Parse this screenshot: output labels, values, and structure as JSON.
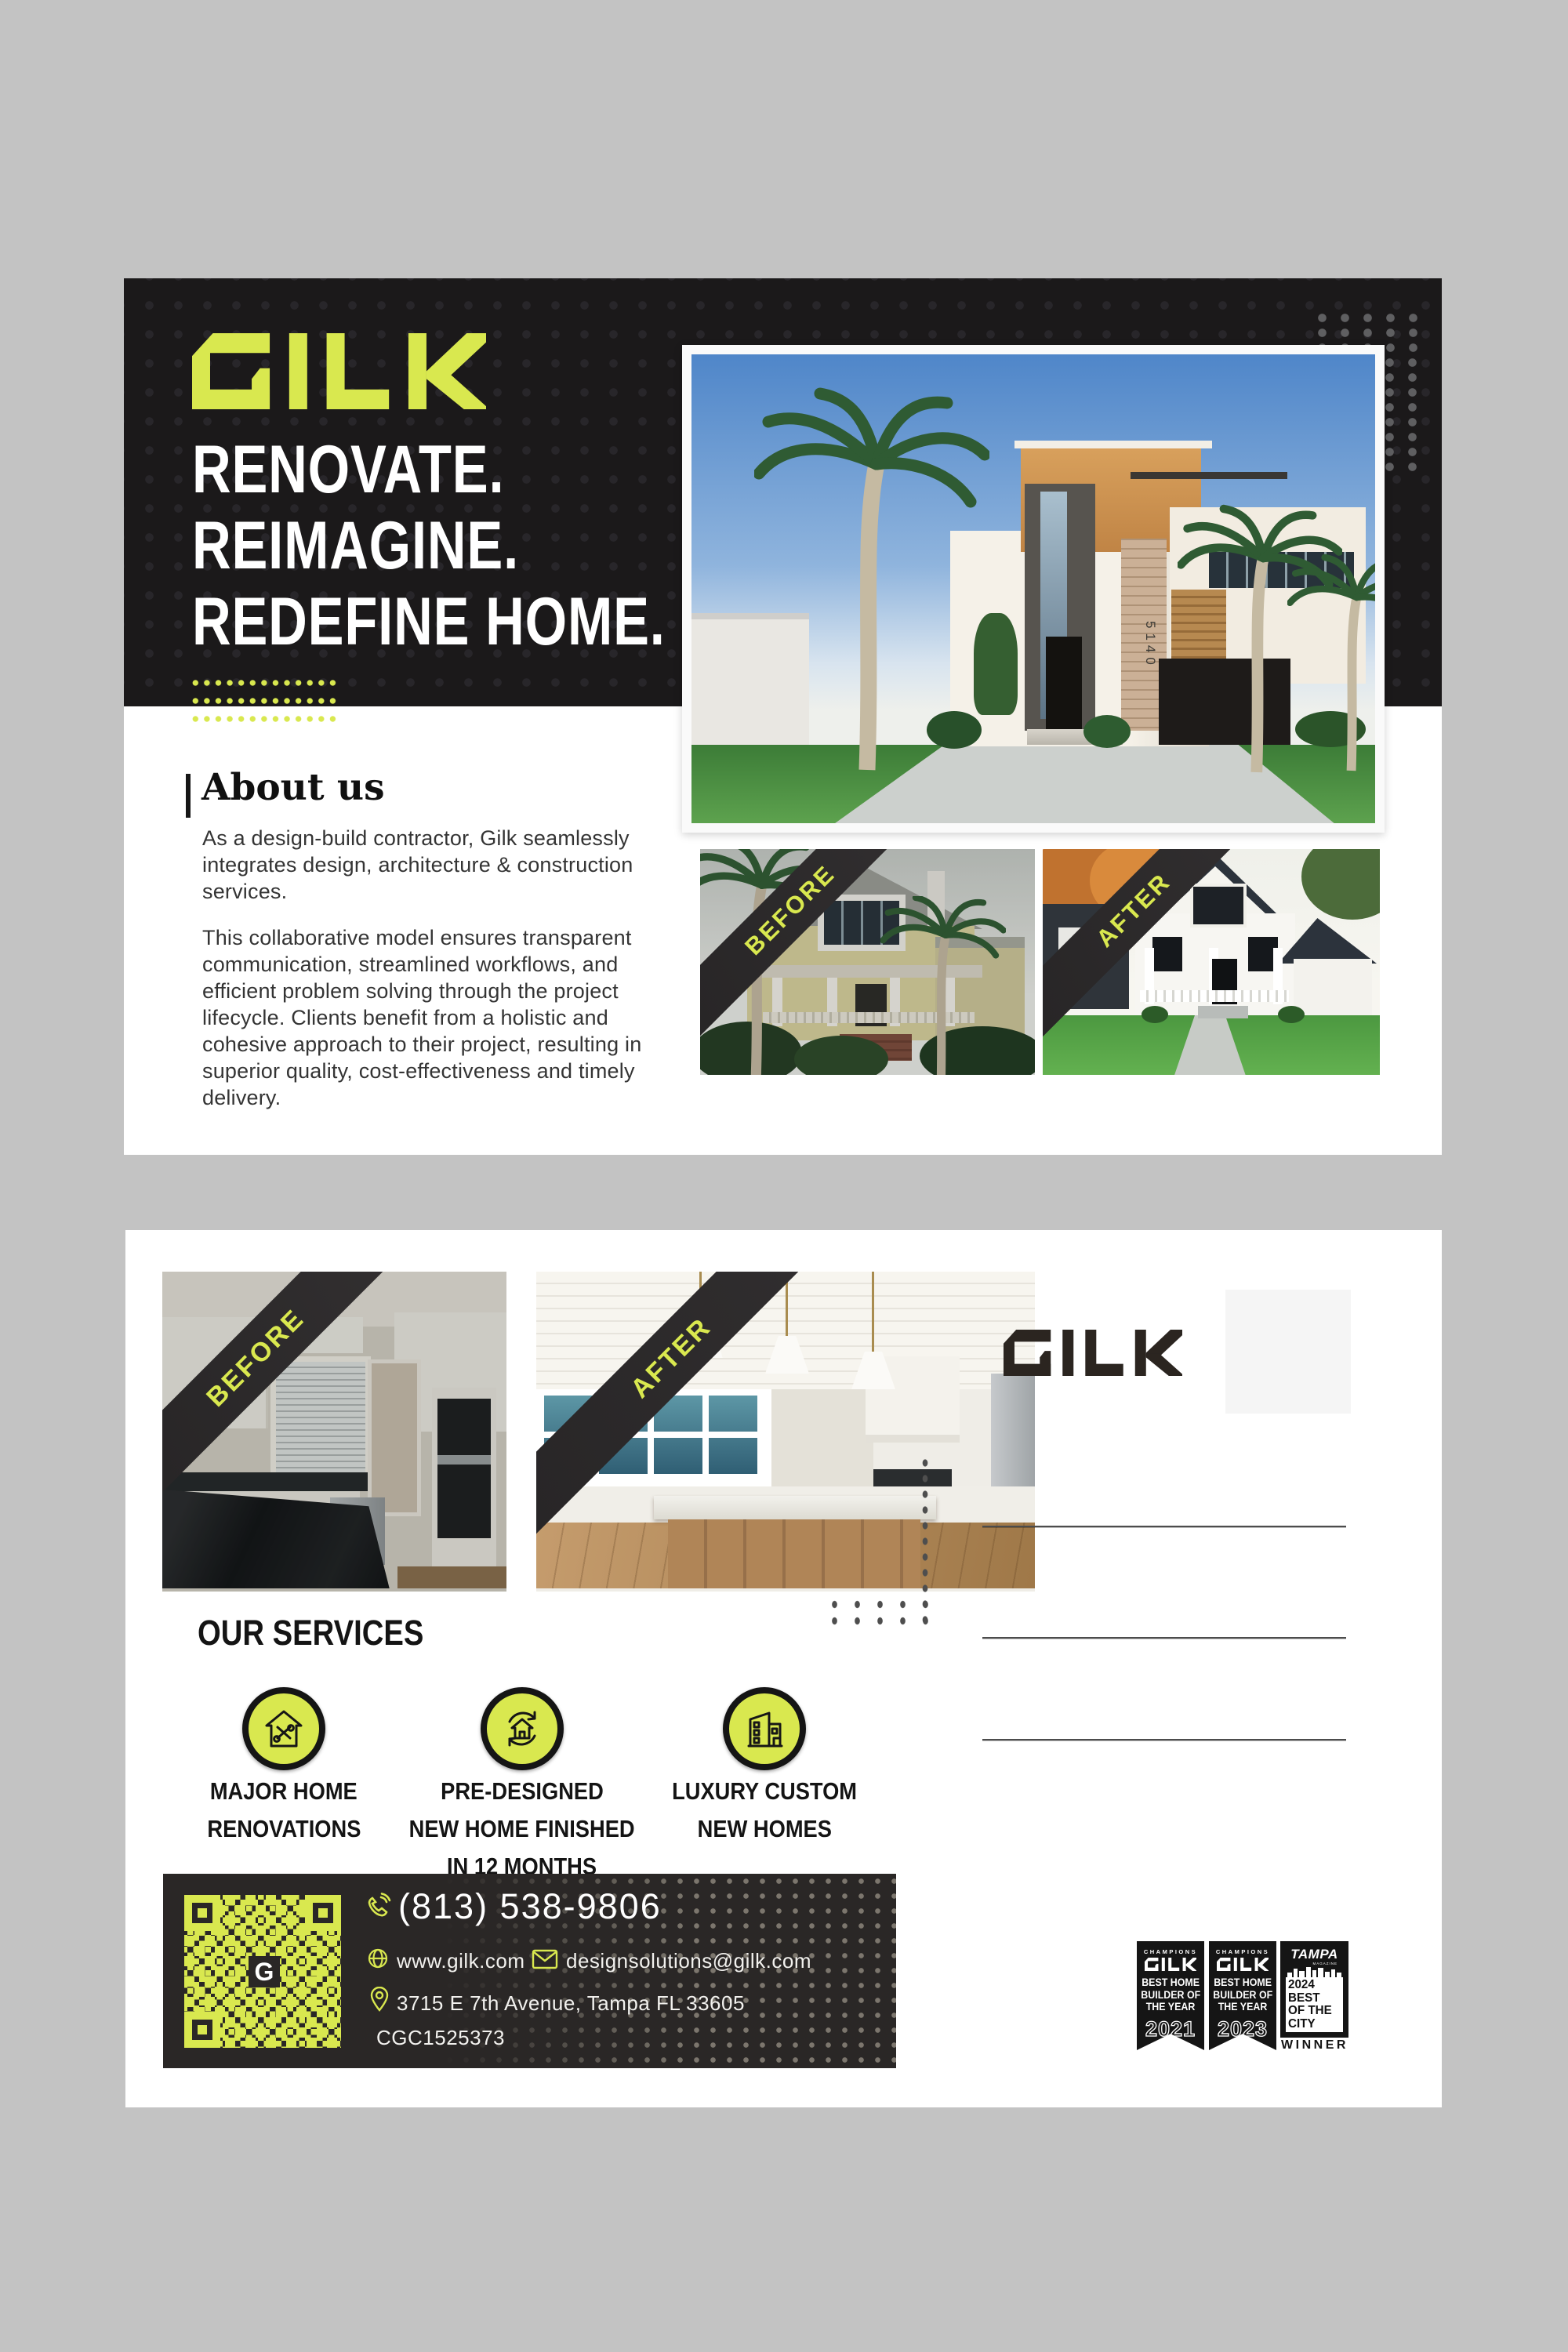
{
  "brand": "GILK",
  "colors": {
    "lime": "#d9e84f",
    "header_dark": "#1b191a",
    "contact_bar": "#2a2726",
    "page_bg": "#c3c3c3",
    "award_black": "#151515"
  },
  "front": {
    "headline": [
      "RENOVATE.",
      "REIMAGINE.",
      "REDEFINE HOME."
    ],
    "about": {
      "title": "About us",
      "p1": "As a design-build contractor, Gilk seamlessly integrates design, architecture & construction services.",
      "p2": "This collaborative model ensures transparent communication, streamlined workflows, and efficient problem solving through the project lifecycle. Clients benefit from a holistic and cohesive approach to their project, resulting in superior quality, cost-effectiveness and timely delivery."
    },
    "photo_labels": {
      "before": "BEFORE",
      "after": "AFTER"
    },
    "hero_house_number": "5140"
  },
  "back": {
    "photo_labels": {
      "before": "BEFORE",
      "after": "AFTER"
    },
    "services": {
      "title": "OUR SERVICES",
      "items": [
        {
          "icon": "house-tools-icon",
          "lines": [
            "MAJOR HOME",
            "RENOVATIONS"
          ]
        },
        {
          "icon": "house-cycle-icon",
          "lines": [
            "PRE-DESIGNED",
            "NEW HOME FINISHED",
            "IN 12 MONTHS"
          ]
        },
        {
          "icon": "modern-home-icon",
          "lines": [
            "LUXURY CUSTOM",
            "NEW HOMES"
          ]
        }
      ]
    },
    "contact": {
      "phone": "(813) 538-9806",
      "website": "www.gilk.com",
      "email": "designsolutions@gilk.com",
      "address": "3715 E 7th Avenue, Tampa FL 33605",
      "license": "CGC1525373",
      "qr_center_letter": "G"
    },
    "awards": [
      {
        "eyebrow": "CHAMPIONS",
        "brand": "GILK",
        "lines": [
          "BEST HOME",
          "BUILDER OF",
          "THE YEAR"
        ],
        "year": "2021"
      },
      {
        "eyebrow": "CHAMPIONS",
        "brand": "GILK",
        "lines": [
          "BEST HOME",
          "BUILDER OF",
          "THE YEAR"
        ],
        "year": "2023"
      },
      {
        "brand": "TAMPA",
        "sub": "MAGAZINE",
        "lines": [
          "2024",
          "BEST",
          "OF THE",
          "CITY"
        ],
        "footer": "WINNER"
      }
    ]
  }
}
